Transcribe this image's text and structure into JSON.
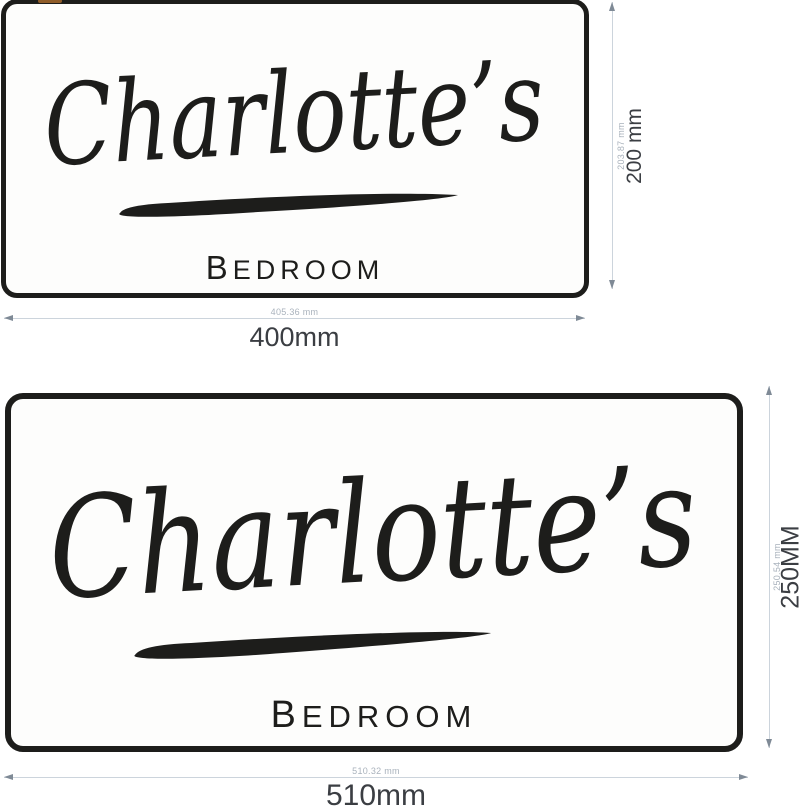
{
  "signs": [
    {
      "script_name": "Charlotte’s",
      "room_label": "BEDROOM",
      "width_label": "400mm",
      "width_precise": "405.36 mm",
      "height_label": "200 mm",
      "height_precise": "203.87 mm"
    },
    {
      "script_name": "Charlotte’s",
      "room_label": "BEDROOM",
      "width_label": "510mm",
      "width_precise": "510.32 mm",
      "height_label": "250MM",
      "height_precise": "250.54 mm"
    }
  ],
  "colors": {
    "ink": "#1d1d1b",
    "sign_background": "#fdfdfc",
    "dimension_line": "#ccd4dc",
    "dimension_arrow": "#7f8a96",
    "dimension_text": "#3b3e43",
    "dimension_text_small": "#a9b2bc",
    "accent_speck": "#b5722f"
  }
}
